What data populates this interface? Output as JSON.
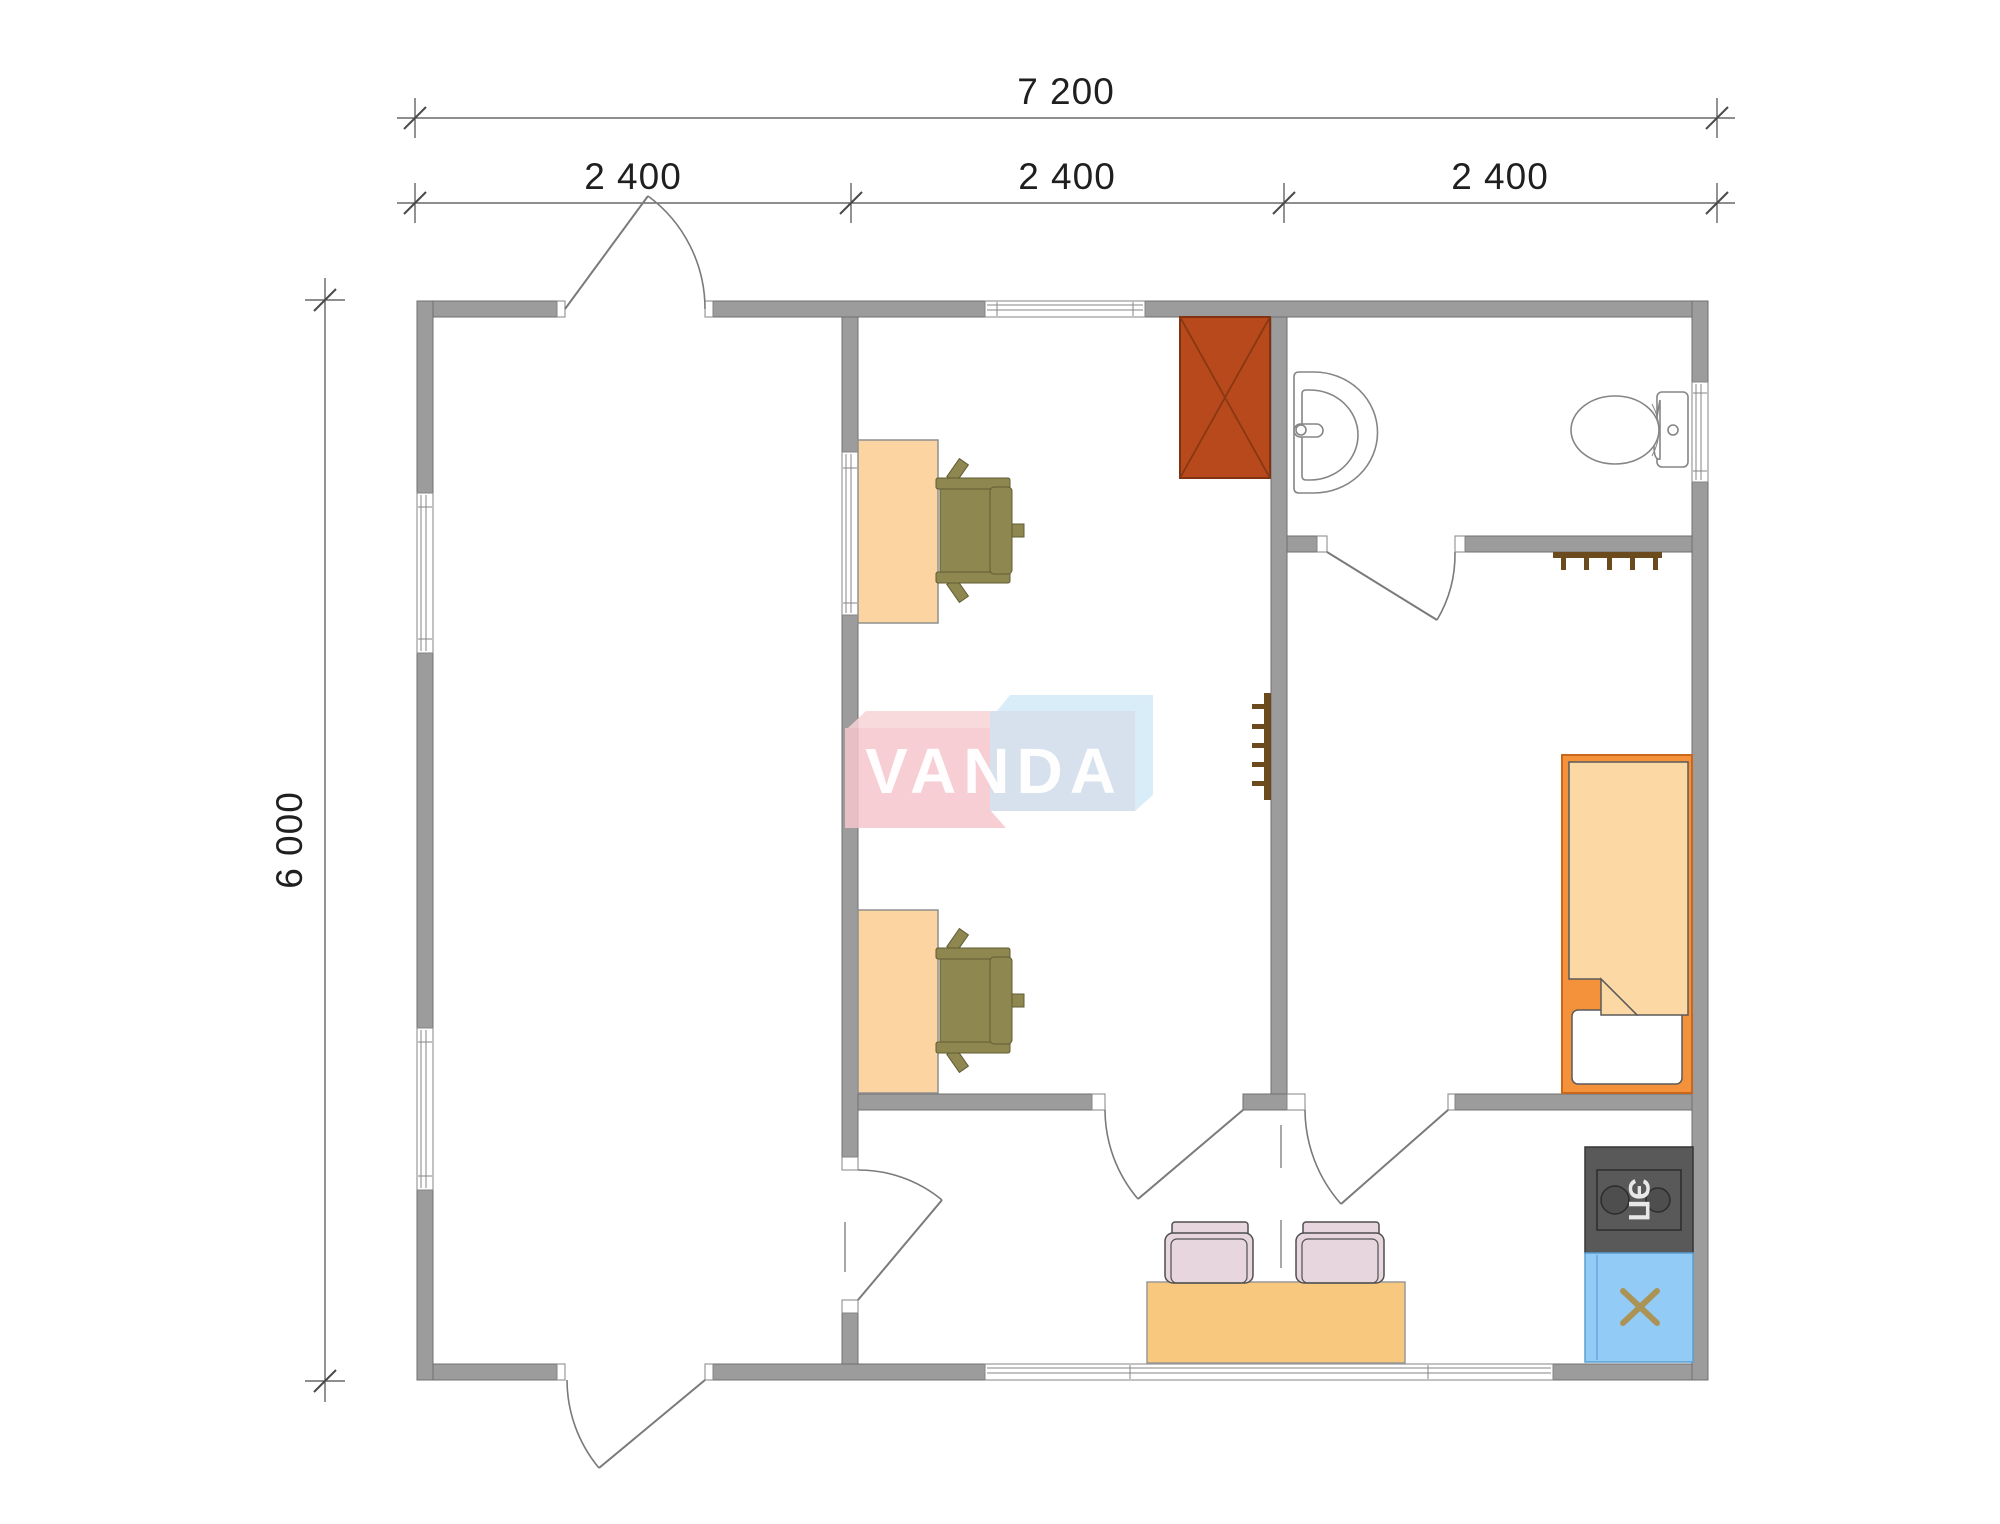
{
  "plan": {
    "dimensions": {
      "total_width_label": "7 200",
      "total_height_label": "6 000",
      "modules": [
        "2 400",
        "2 400",
        "2 400"
      ]
    },
    "watermark": {
      "text": "VANDA"
    },
    "kitchen": {
      "stove_label": "ЭП"
    }
  },
  "colors": {
    "wall_fill": "#9c9c9c",
    "wall_stroke": "#6f6f6f",
    "door_stroke": "#7a7a7a",
    "fixture_stroke": "#858585",
    "dim_line": "#4a4a4a",
    "dim_text": "#1f1f1f",
    "wardrobe_fill": "#b8491d",
    "wardrobe_stroke": "#7f3310",
    "wardrobe_cross": "#8a3812",
    "desk_fill": "#fbd4a2",
    "desk_stroke": "#8f8f8f",
    "chair_olive": "#8f8750",
    "chair_olive_stroke": "#615b33",
    "table_fill": "#f9c87f",
    "hall_chair": "#e7d6dd",
    "hall_chair_stroke": "#4f4f4f",
    "counter_fill": "#595959",
    "counter_stroke": "#353535",
    "burner_stroke": "#2c2c2c",
    "sinkunit_fill": "#92cbf5",
    "sinkunit_stroke": "#5a9fd4",
    "cross_khaki": "#ab9355",
    "bed_frame": "#f4913b",
    "bed_frame_stroke": "#c9671a",
    "blanket_fill": "#fcd8a5",
    "blanket_stroke": "#5a5a5a",
    "rack_fill": "#6b4a1d",
    "logo_pink": "#f5c6cb",
    "logo_pink_light": "#f8d3d6",
    "logo_blue_face": "#ccd9e9",
    "logo_blue_light": "#cfe9f8",
    "stove_label_fill": "#e8e8e8"
  }
}
